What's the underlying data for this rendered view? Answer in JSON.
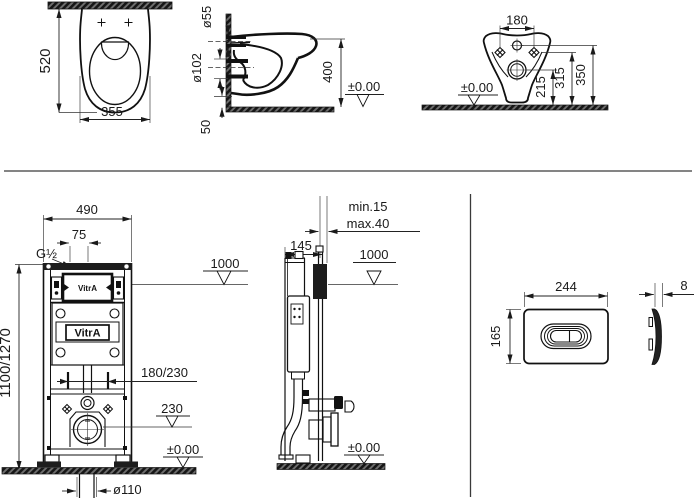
{
  "brand": "VitrA",
  "pan_plan": {
    "depth": "520",
    "width": "355"
  },
  "pan_side": {
    "inlet_dia": "ø55",
    "outlet_dia": "ø102",
    "height": "400",
    "floor_gap": "50",
    "datum": "±0.00"
  },
  "pan_rear": {
    "hole_spacing": "180",
    "outlet_height": "215",
    "hole_height": "315",
    "inlet_height": "350",
    "datum": "±0.00"
  },
  "frame_front": {
    "width": "490",
    "inlet_offset": "75",
    "inlet_thread": "G½",
    "actuation_height": "1000",
    "height": "1100/1270",
    "stud_spacing": "180/230",
    "outlet_height": "230",
    "datum": "±0.00",
    "waste_dia": "ø110"
  },
  "frame_side": {
    "wall_min": "min.15",
    "wall_max": "max.40",
    "depth": "145",
    "actuation_height": "1000",
    "datum": "±0.00"
  },
  "flush_plate": {
    "width": "244",
    "height": "165",
    "thickness": "8"
  }
}
